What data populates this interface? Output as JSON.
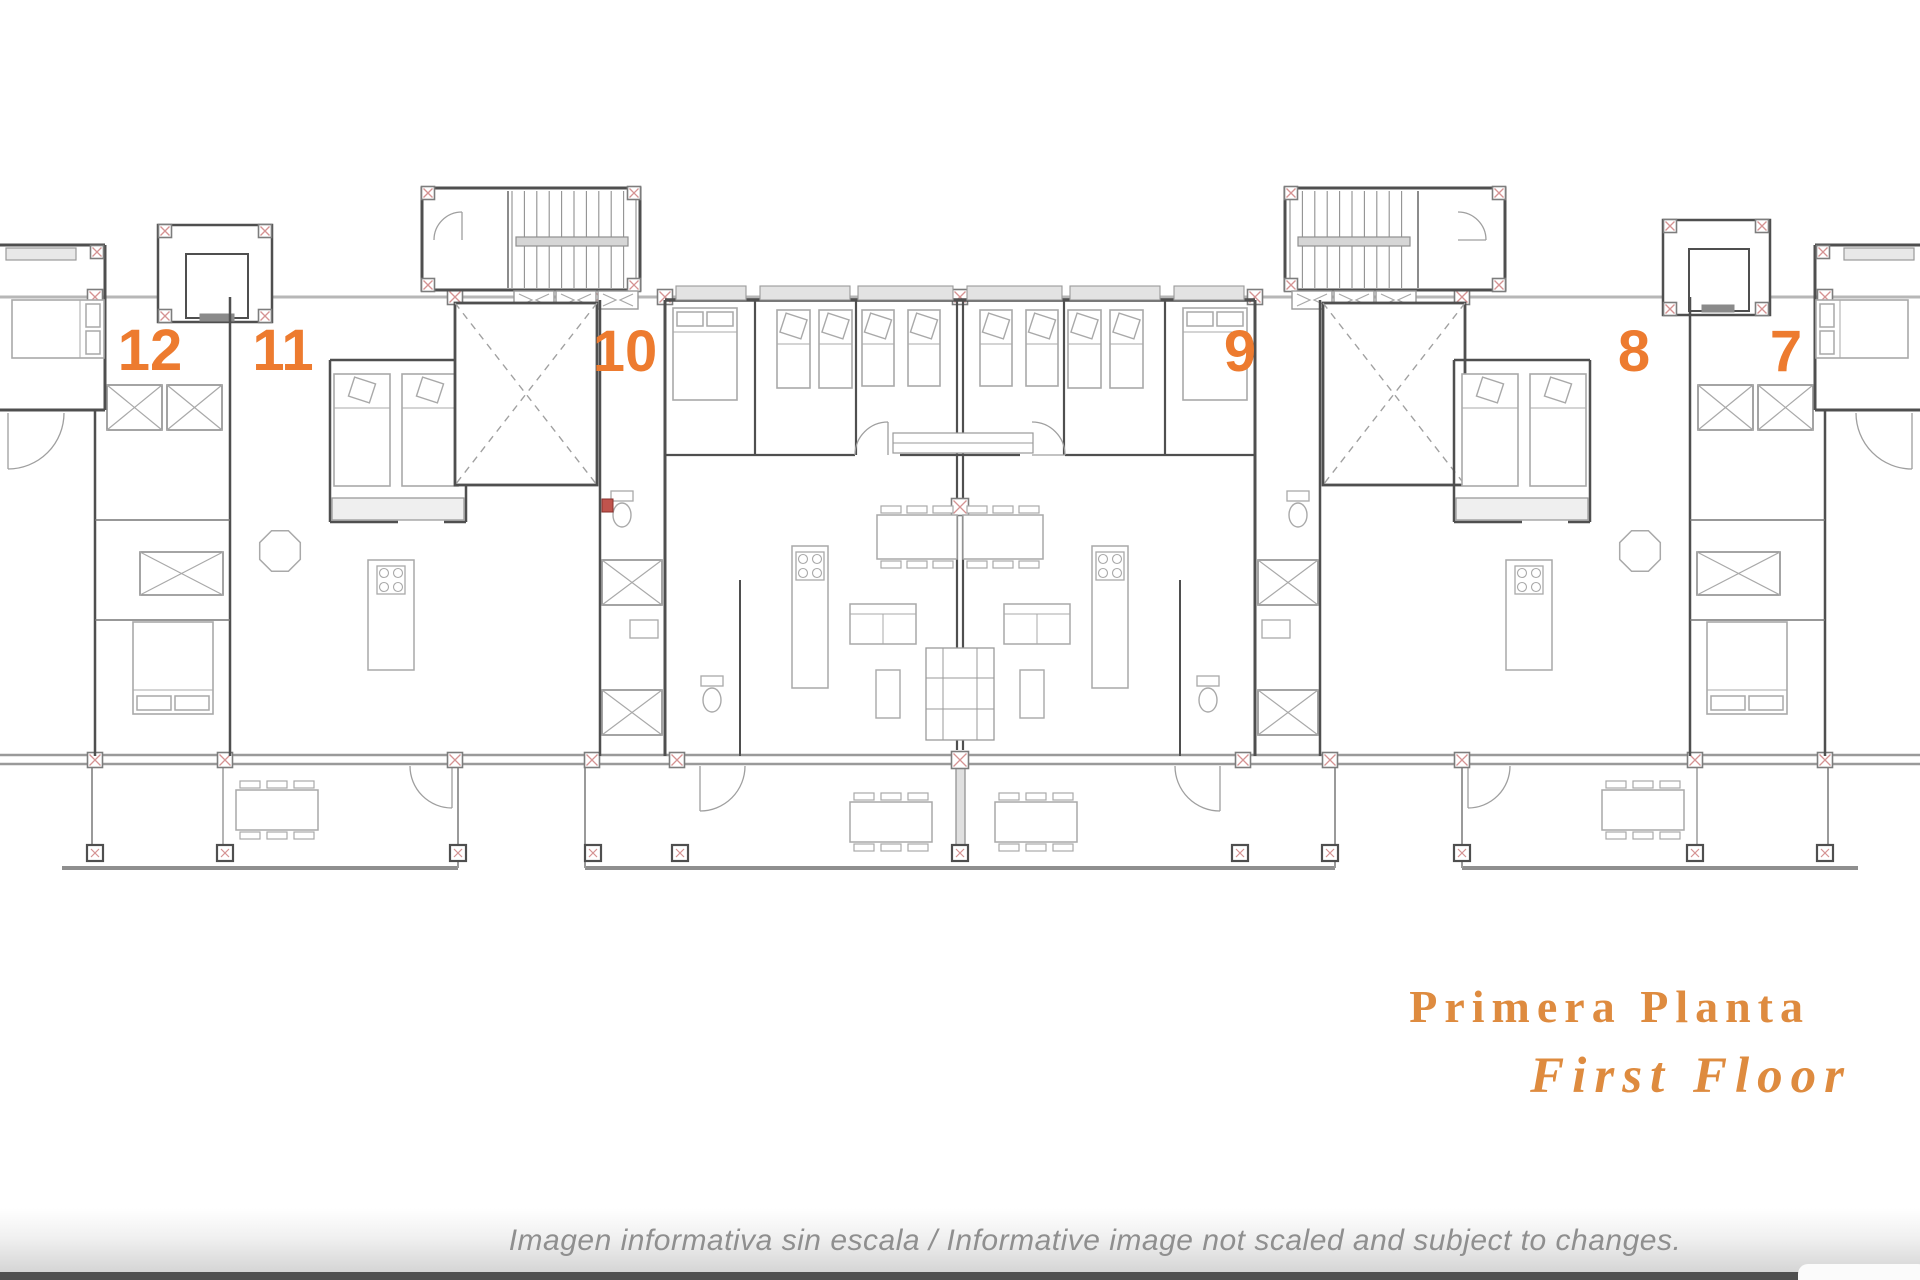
{
  "title": {
    "line1": "Primera Planta",
    "line2": "First Floor",
    "color": "#de8b3f"
  },
  "units": {
    "label_color": "#ed7b2f",
    "labels": [
      {
        "n": "12",
        "x": 150,
        "y": 351
      },
      {
        "n": "11",
        "x": 283,
        "y": 351
      },
      {
        "n": "10",
        "x": 625,
        "y": 352
      },
      {
        "n": "9",
        "x": 1240,
        "y": 352
      },
      {
        "n": "8",
        "x": 1634,
        "y": 352
      },
      {
        "n": "7",
        "x": 1786,
        "y": 352
      }
    ]
  },
  "footer": {
    "text": "Imagen informativa sin escala /  Informative image not scaled and subject to changes.",
    "color": "#8f8f8f"
  },
  "plan": {
    "background": "#ffffff",
    "wall_color": "#4f4f4f",
    "line_color": "#9a9a9a",
    "light_line_color": "#b7b7b7",
    "furniture_color": "#a9a9a9",
    "pillar_cross_color": "#d59393",
    "accent_red": "#c0544d"
  }
}
